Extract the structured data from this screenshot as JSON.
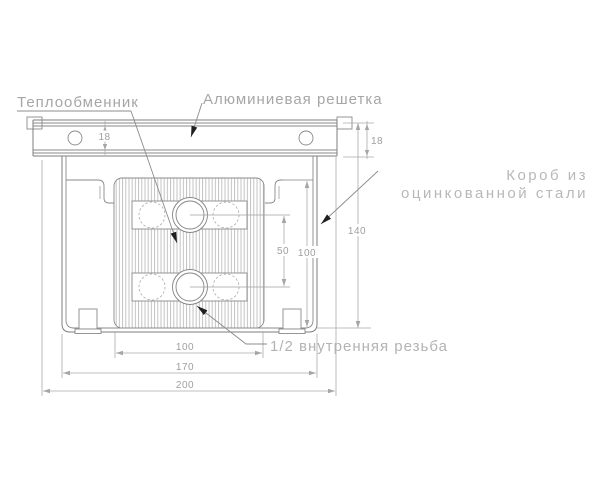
{
  "drawing": {
    "labels": {
      "heat_exchanger": "Теплообменник",
      "aluminum_grille": "Алюминиевая решетка",
      "box_line1": "Короб из",
      "box_line2": "оцинкованной стали",
      "thread_note": "1/2 внутренняя резьба"
    },
    "dimensions": {
      "grille_profile_height_left": "18",
      "grille_profile_height_right": "18",
      "overall_height": "140",
      "core_height": "100",
      "tube_pitch": "50",
      "core_width": "100",
      "box_width": "170",
      "overall_width": "200"
    },
    "colors": {
      "background": "#ffffff",
      "outline": "#7d7d7d",
      "dimension_lines": "#aaaaaa",
      "label_text": "#a6a6a6",
      "leader_arrow": "#1f1f1f"
    }
  }
}
